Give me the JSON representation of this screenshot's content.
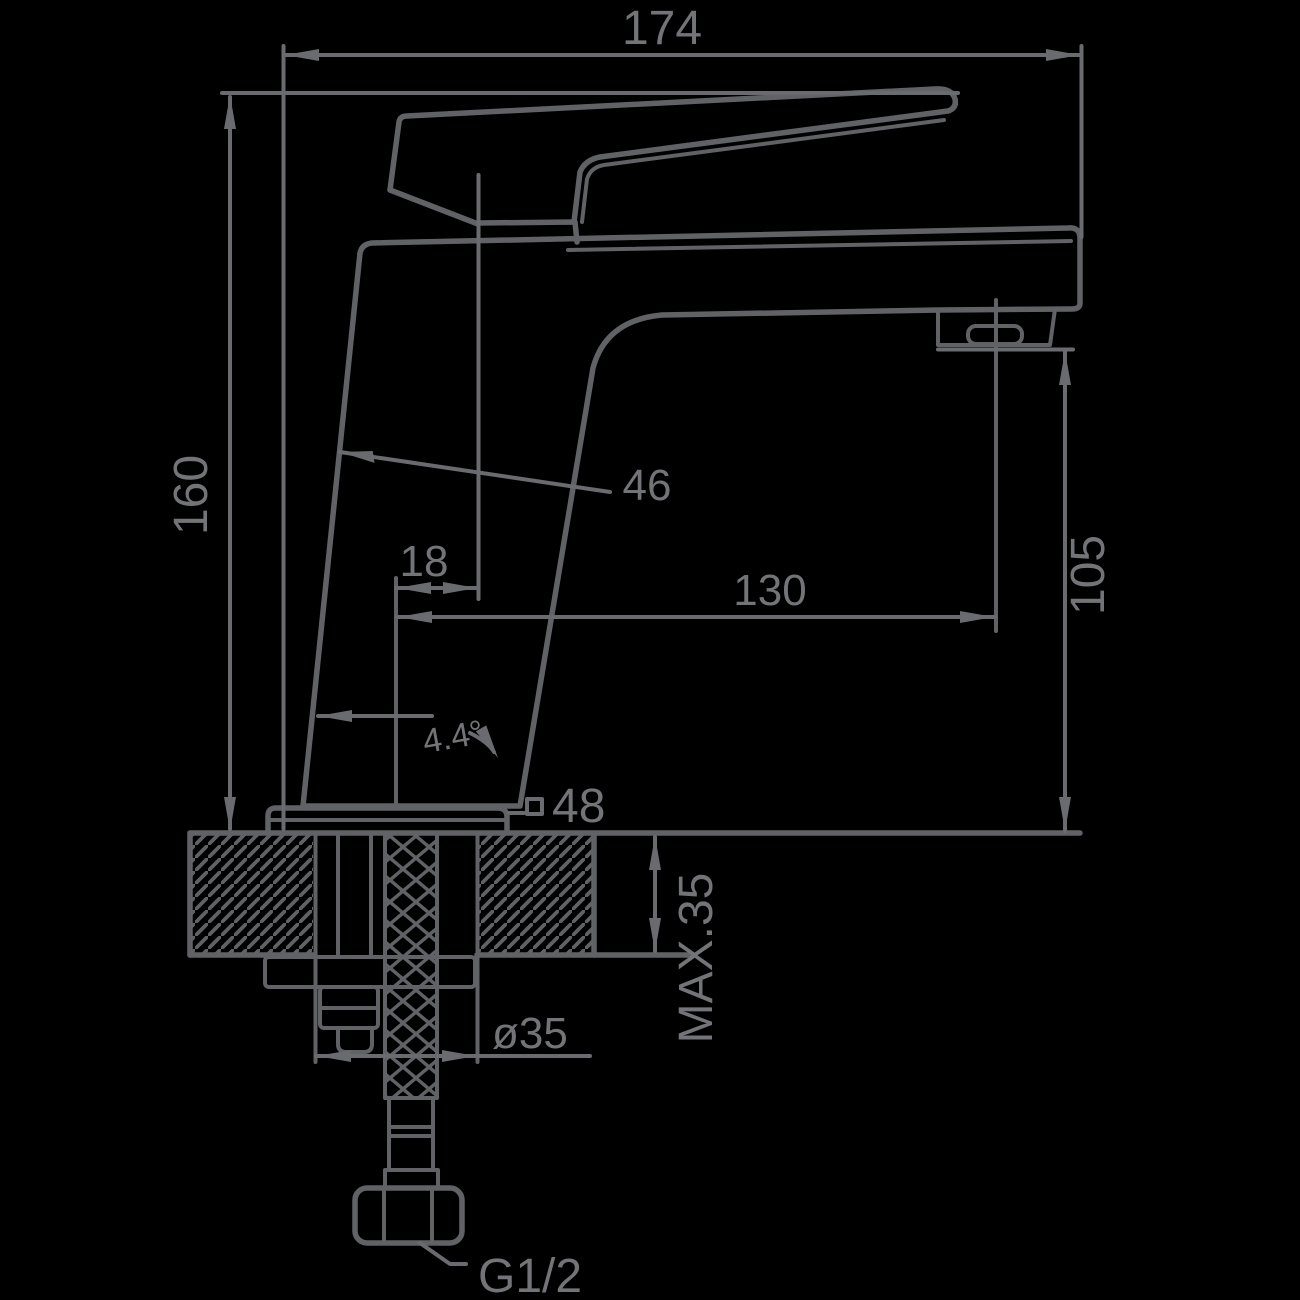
{
  "meta": {
    "background_color": "#000000",
    "line_color": "#616266",
    "text_color": "#737477",
    "drawing_type": "faucet installation dimension drawing"
  },
  "dimensions": {
    "overall_width": "174",
    "overall_height": "160",
    "body_width": "46",
    "handle_to_axis": "18",
    "spout_reach": "130",
    "spout_outlet_height": "105",
    "body_tilt_angle": "4.4°",
    "base_square_value": "48",
    "hole_diameter": "ø35",
    "max_mounting_thickness": "MAX.35",
    "connection_thread": "G1/2"
  },
  "symbols": {
    "square_symbol": "square-outline before 48 (48 x 48 base)",
    "diameter_symbol": "ø (hole diameter)"
  }
}
